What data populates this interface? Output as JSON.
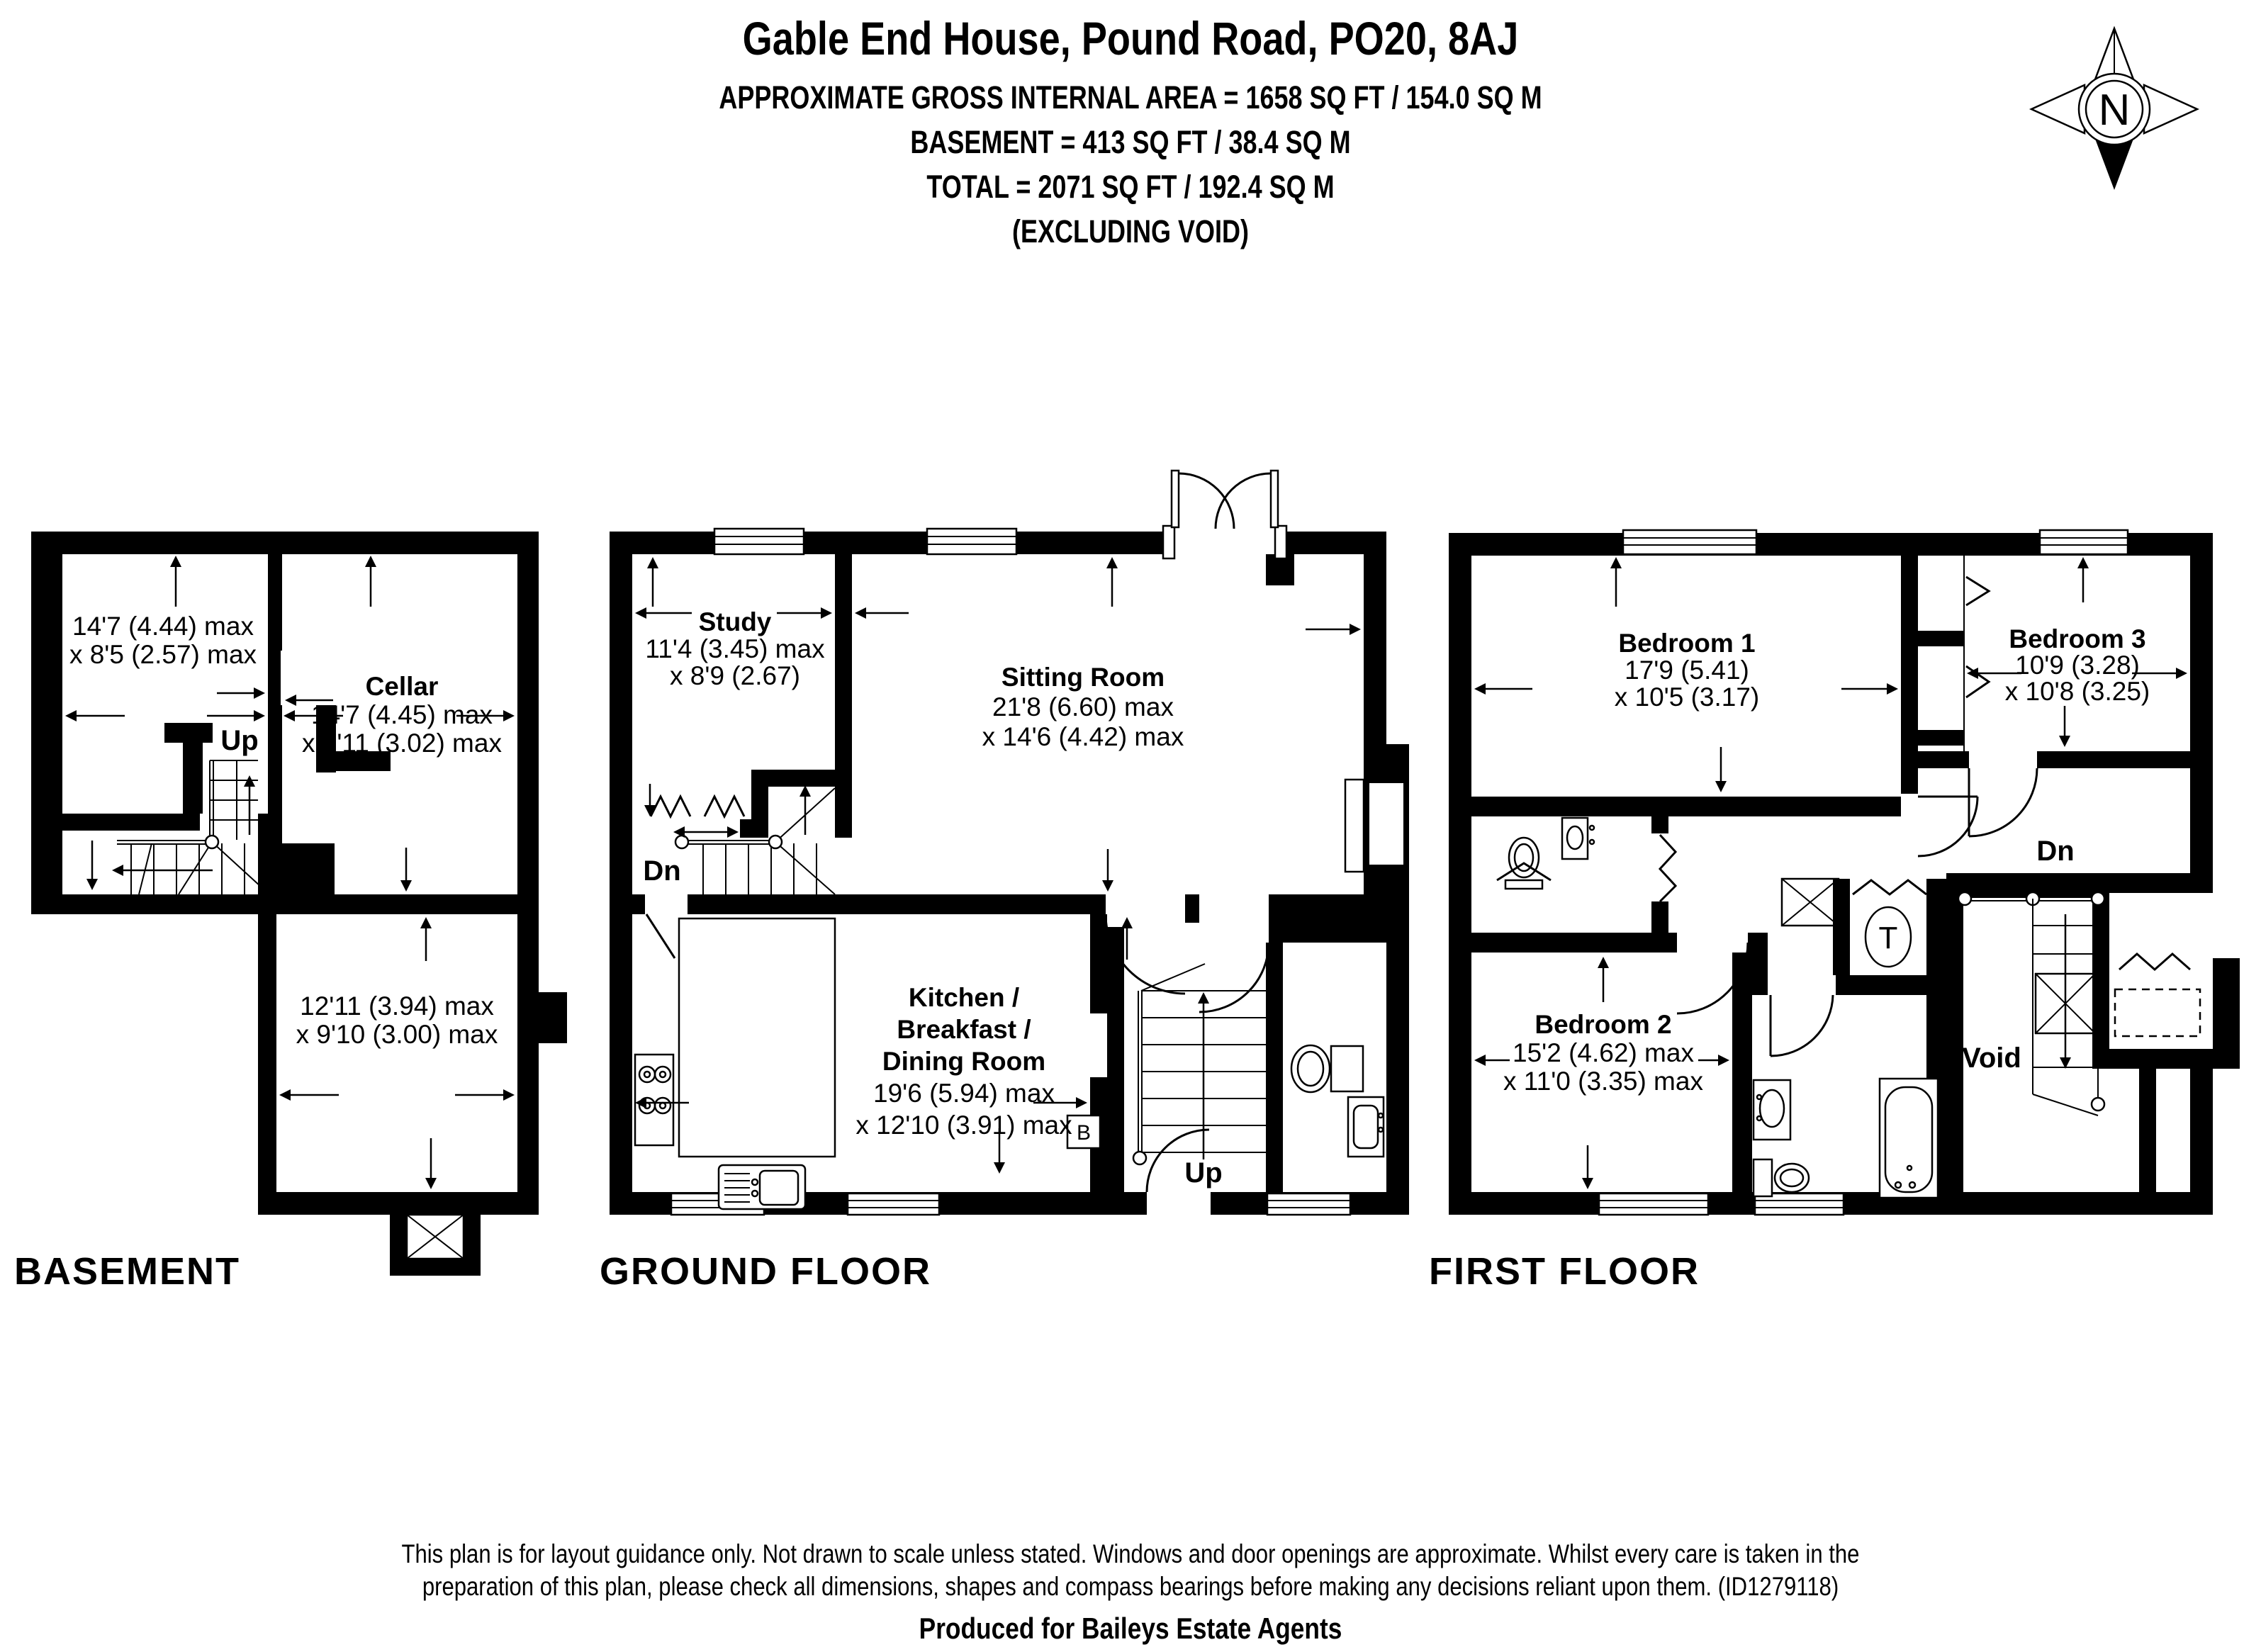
{
  "header": {
    "title": "Gable End House, Pound Road, PO20, 8AJ",
    "area_line": "APPROXIMATE GROSS INTERNAL AREA = 1658 SQ FT / 154.0 SQ M",
    "basement_line": "BASEMENT = 413 SQ FT / 38.4 SQ M",
    "total_line": "TOTAL = 2071 SQ FT / 192.4 SQ M",
    "excluding_line": "(EXCLUDING VOID)"
  },
  "compass": {
    "label": "N"
  },
  "floors": {
    "basement": {
      "label": "BASEMENT",
      "stairs_label": "Up",
      "rooms": {
        "store": {
          "dim1": "14'7 (4.44) max",
          "dim2": "x 8'5 (2.57) max"
        },
        "cellar": {
          "name": "Cellar",
          "dim1": "14'7 (4.45) max",
          "dim2": "x 9'11 (3.02) max"
        },
        "lower_room": {
          "dim1": "12'11 (3.94) max",
          "dim2": "x 9'10 (3.00) max"
        }
      }
    },
    "ground": {
      "label": "GROUND FLOOR",
      "stairs_down_label": "Dn",
      "stairs_up_label": "Up",
      "boiler_label": "B",
      "rooms": {
        "study": {
          "name": "Study",
          "dim1": "11'4 (3.45) max",
          "dim2": "x 8'9 (2.67)"
        },
        "sitting_room": {
          "name": "Sitting Room",
          "dim1": "21'8 (6.60) max",
          "dim2": "x 14'6 (4.42) max"
        },
        "kitchen": {
          "name1": "Kitchen /",
          "name2": "Breakfast /",
          "name3": "Dining Room",
          "dim1": "19'6 (5.94) max",
          "dim2": "x 12'10 (3.91) max"
        }
      }
    },
    "first": {
      "label": "FIRST FLOOR",
      "stairs_label": "Dn",
      "void_label": "Void",
      "tank_label": "T",
      "rooms": {
        "bedroom1": {
          "name": "Bedroom 1",
          "dim1": "17'9 (5.41)",
          "dim2": "x 10'5 (3.17)"
        },
        "bedroom3": {
          "name": "Bedroom 3",
          "dim1": "10'9 (3.28)",
          "dim2": "x 10'8 (3.25)"
        },
        "bedroom2": {
          "name": "Bedroom 2",
          "dim1": "15'2 (4.62) max",
          "dim2": "x 11'0 (3.35) max"
        }
      }
    }
  },
  "footer": {
    "line1": "This plan is for layout guidance only. Not drawn to scale unless stated. Windows and door openings are approximate. Whilst every care is taken in the",
    "line2": "preparation of this plan, please check all dimensions, shapes and compass bearings before making any decisions reliant upon them. (ID1279118)",
    "credit": "Produced for Baileys Estate Agents"
  },
  "colors": {
    "ink": "#000000",
    "paper": "#ffffff"
  }
}
